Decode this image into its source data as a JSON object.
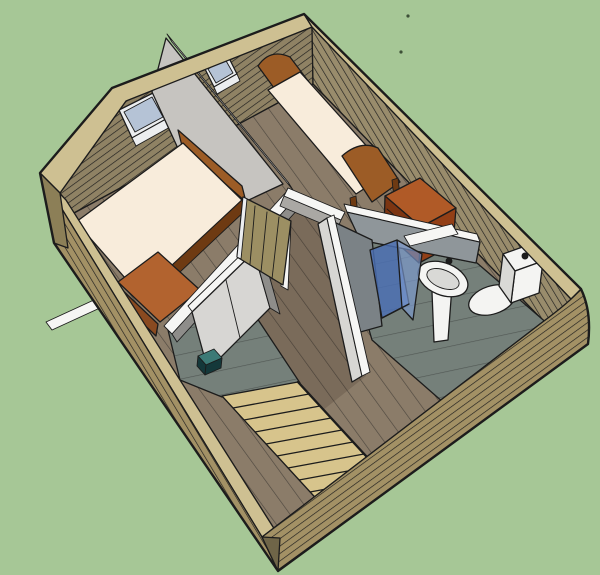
{
  "scene": {
    "view": "3d-model-cutaway",
    "counts": {
      "windows": 2,
      "beds": 2,
      "stair_treads": 8,
      "closet_door_panels": 2,
      "shower_glass_panels": 2,
      "dresser_drawers": 3
    },
    "objects": [
      "exterior-walls",
      "left-bedroom",
      "right-bedroom",
      "bathroom",
      "hallway",
      "stair-landing",
      "staircase",
      "left-bed",
      "right-bed",
      "foot-chest",
      "dresser",
      "hall-closet",
      "open-door",
      "center-partition-wall",
      "shower-enclosure",
      "pedestal-sink",
      "toilet",
      "roof-window",
      "teal-step",
      "render-specks"
    ]
  },
  "palette": {
    "bg": "#a6c796",
    "outline": "#1c1c1c",
    "strip": "#cec092",
    "ext_face": "#a39165",
    "ext_face_dark": "#8c7f57",
    "corner_dark": "#6f6548",
    "int_wall_left": "#8f8264",
    "int_wall_right": "#998c6c",
    "partition_light": "#c6c4c0",
    "partition_mid": "#aaa8a4",
    "partition_dark": "#8e8d8a",
    "wall_white": "#f6f6f4",
    "closet_panel": "#d7d6d3",
    "closet_seam": "#6b6b69",
    "bath_wall": "#8f969a",
    "bath_wall_dark": "#7b8286",
    "floor_wood": "#8b7c69",
    "plank_seam": "#6d6052",
    "floor_tint": "rgba(56,42,30,0.20)",
    "tile": "#75807a",
    "tile_seam": "#5e6963",
    "mattress": "#f8ecdb",
    "bed_frame": "#9c5c26",
    "bed_frame_dark": "#6e3a12",
    "dresser_top": "#b05a27",
    "dresser_front": "#933f16",
    "dresser_side": "#7c3512",
    "chest": "#b2632f",
    "chest_dark": "#8a4a20",
    "stair_tread": "#d7c48c",
    "door_wood": "#9c8f63",
    "door_grain": "#7e7248",
    "shower_blue": "#4a6fb5",
    "shower_blue_light": "#7b9ad0",
    "shower_stroke": "#23406e",
    "fixture_white": "#f4f4f2",
    "fixture_shade": "#d9d9d6",
    "fixture_rim": "#9a9a98",
    "window_glass": "#b5c3d6",
    "window_frame": "#eceef0",
    "teal_top": "#3c7a76",
    "teal_front": "#14383a",
    "speck": "#3d5037",
    "grain_line": "rgba(60,50,25,0.12)"
  }
}
